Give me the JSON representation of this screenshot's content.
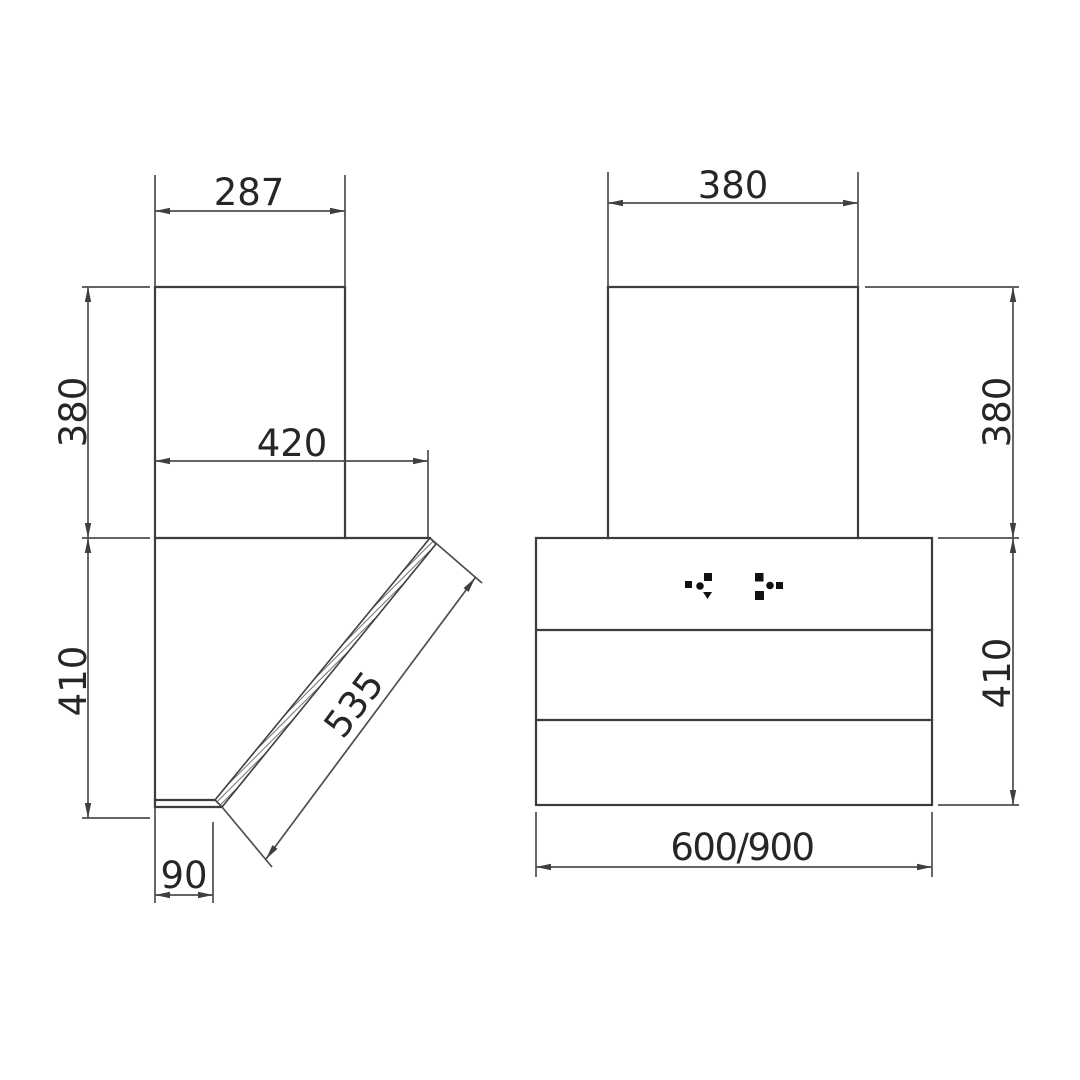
{
  "drawing": {
    "type": "technical-dimension-drawing",
    "subject": "cooker-hood-two-view-diagram",
    "units_note": "",
    "colors": {
      "background": "#ffffff",
      "object_line": "#3c3c3c",
      "dimension_line": "#4e4e4e",
      "text": "#262626",
      "hatch": "#5a5a5a",
      "control_dots": "#111111"
    },
    "side_view": {
      "name": "side-view",
      "dim_chimney_width": "287",
      "dim_chimney_height": "380",
      "dim_top_depth": "420",
      "dim_body_height": "410",
      "dim_panel_length": "535",
      "dim_bottom_depth": "90"
    },
    "front_view": {
      "name": "front-view",
      "dim_chimney_width": "380",
      "dim_chimney_height": "380",
      "dim_body_height": "410",
      "dim_body_width": "600/900",
      "icons": {
        "left_control": "touch-control-dots-left",
        "right_control": "touch-control-dots-right"
      }
    }
  }
}
